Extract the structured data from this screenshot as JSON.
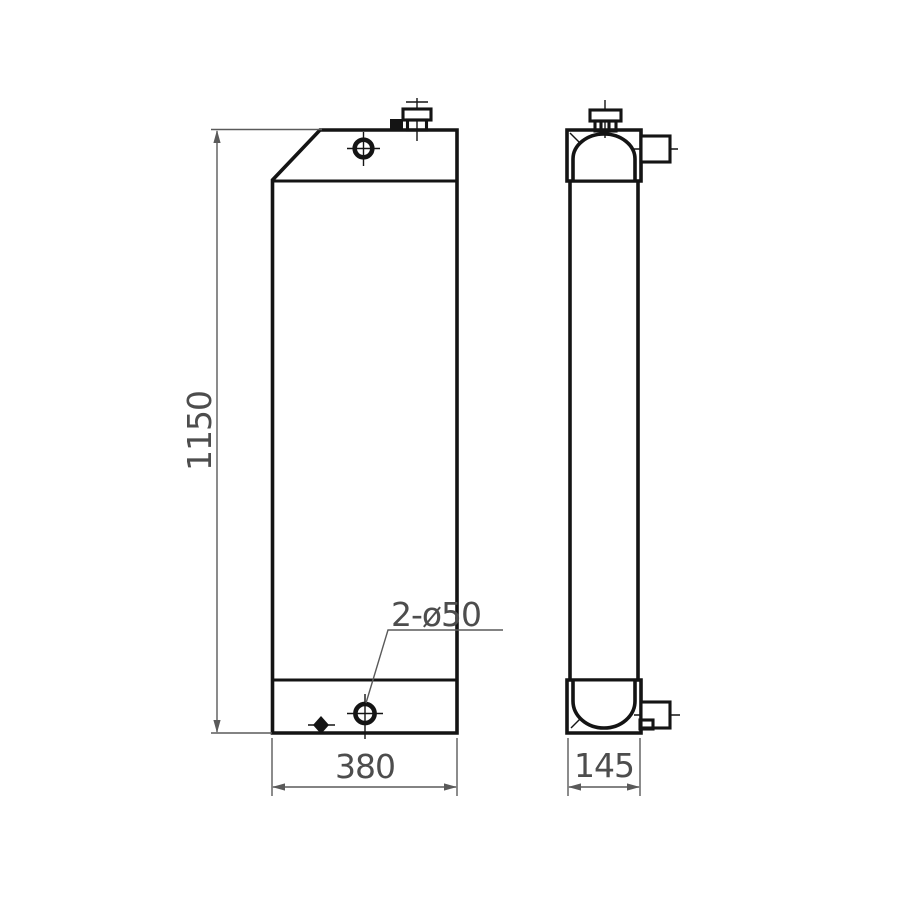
{
  "drawing": {
    "type": "technical-drawing-two-views",
    "views": {
      "front": {
        "labels": {
          "height": "1150",
          "width": "380",
          "hole_callout": "2-ø50"
        }
      },
      "side": {
        "labels": {
          "depth": "145"
        }
      }
    },
    "colors": {
      "background": "#ffffff",
      "object_line": "#141414",
      "dimension_line": "#5a5a5a",
      "text": "#4d4d4d"
    }
  }
}
